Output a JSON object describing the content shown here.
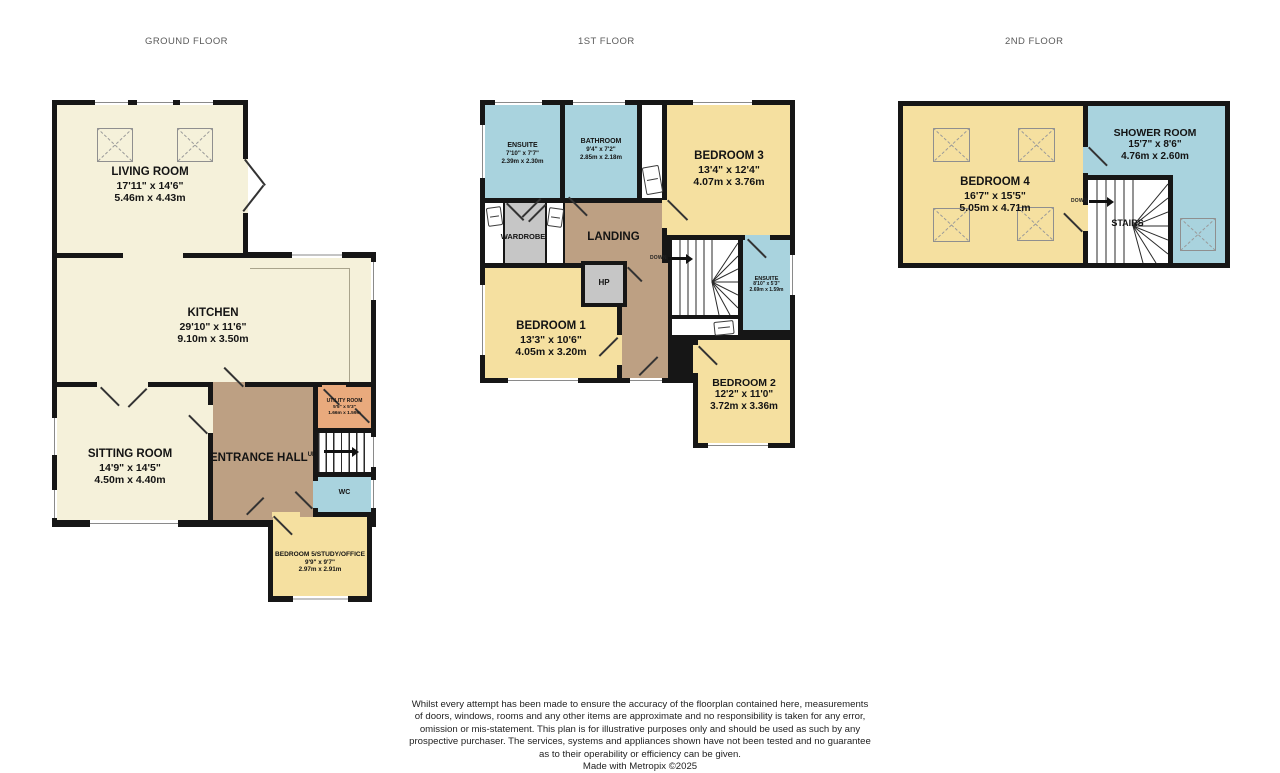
{
  "palette": {
    "room_cream": "#f5f1da",
    "room_yellow": "#f5e0a0",
    "room_blue": "#a9d3de",
    "hall_brown": "#bda083",
    "utility_orange": "#e9aa7d",
    "wardrobe_gray": "#c6c6c6",
    "wall_black": "#161616",
    "title_gray": "#5a5a5a"
  },
  "titles": {
    "ground": "GROUND FLOOR",
    "first": "1ST FLOOR",
    "second": "2ND FLOOR"
  },
  "labels": {
    "up": "UP",
    "down": "DOWN",
    "stairs": "STAIRS"
  },
  "floors": {
    "ground": {
      "rooms": {
        "living": {
          "name": "LIVING ROOM",
          "ft": "17'11\" x 14'6\"",
          "m": "5.46m x 4.43m"
        },
        "kitchen": {
          "name": "KITCHEN",
          "ft": "29'10\" x 11'6\"",
          "m": "9.10m x 3.50m"
        },
        "sitting": {
          "name": "SITTING ROOM",
          "ft": "14'9\" x 14'5\"",
          "m": "4.50m x 4.40m"
        },
        "hall": {
          "name": "ENTRANCE HALL"
        },
        "utility": {
          "name": "UTILITY ROOM",
          "ft": "5'5\" x 5'3\"",
          "m": "1.66m x 1.59m"
        },
        "wc": {
          "name": "WC"
        },
        "bed5": {
          "name": "BEDROOM 5/STUDY/OFFICE",
          "ft": "9'9\" x 9'7\"",
          "m": "2.97m x 2.91m"
        }
      }
    },
    "first": {
      "rooms": {
        "ensuite_a": {
          "name": "ENSUITE",
          "ft": "7'10\" x 7'7\"",
          "m": "2.39m x 2.30m"
        },
        "bathroom": {
          "name": "BATHROOM",
          "ft": "9'4\" x 7'2\"",
          "m": "2.85m x 2.18m"
        },
        "bed3": {
          "name": "BEDROOM 3",
          "ft": "13'4\" x 12'4\"",
          "m": "4.07m x 3.76m"
        },
        "wardrobe": {
          "name": "WARDROBE"
        },
        "landing": {
          "name": "LANDING"
        },
        "hp": {
          "name": "HP"
        },
        "bed1": {
          "name": "BEDROOM 1",
          "ft": "13'3\" x 10'6\"",
          "m": "4.05m x 3.20m"
        },
        "ensuite_b": {
          "name": "ENSUITE",
          "ft": "8'10\" x 5'3\"",
          "m": "2.69m x 1.59m"
        },
        "bed2": {
          "name": "BEDROOM 2",
          "ft": "12'2\" x 11'0\"",
          "m": "3.72m x 3.36m"
        }
      }
    },
    "second": {
      "rooms": {
        "bed4": {
          "name": "BEDROOM 4",
          "ft": "16'7\" x 15'5\"",
          "m": "5.05m x 4.71m"
        },
        "shower": {
          "name": "SHOWER ROOM",
          "ft": "15'7\" x 8'6\"",
          "m": "4.76m x 2.60m"
        }
      }
    }
  },
  "footer": {
    "lines": [
      "Whilst every attempt has been made to ensure the accuracy of the floorplan contained here, measurements",
      "of doors, windows, rooms and any other items are approximate and no responsibility is taken for any error,",
      "omission or mis-statement. This plan is for illustrative purposes only and should be used as such by any",
      "prospective purchaser. The services, systems and appliances shown have not been tested and no guarantee",
      "as to their operability or efficiency can be given."
    ],
    "credit": "Made with Metropix ©2025"
  }
}
